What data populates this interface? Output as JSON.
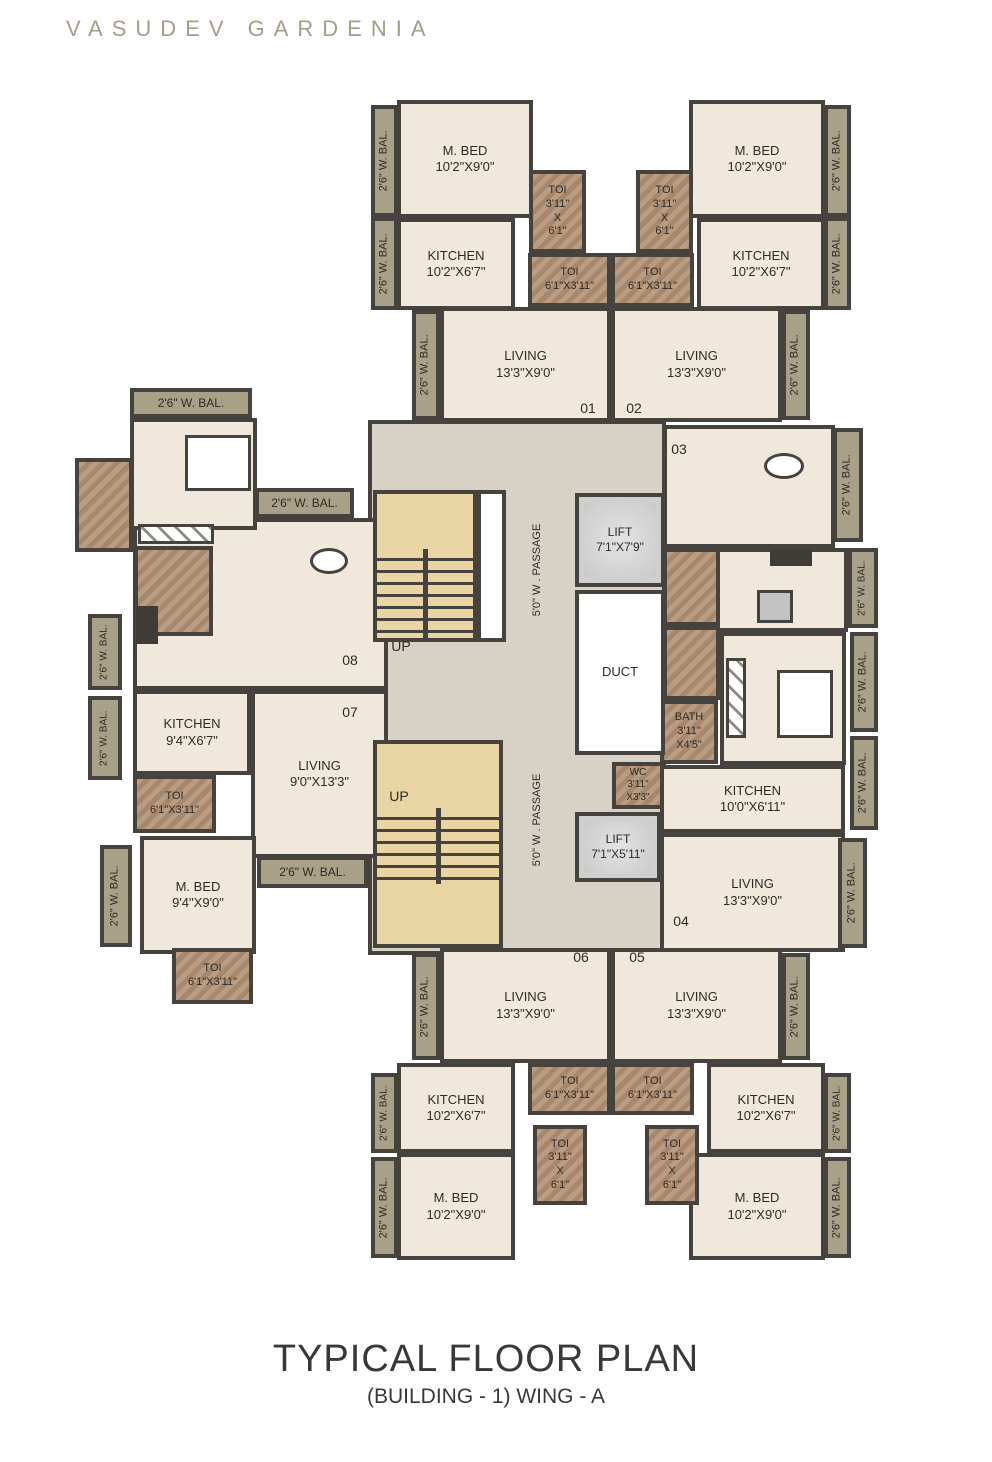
{
  "header": {
    "title": "VASUDEV GARDENIA"
  },
  "footer": {
    "title": "TYPICAL FLOOR PLAN",
    "subtitle": "(BUILDING - 1) WING - A"
  },
  "colors": {
    "wall": "#46433e",
    "floor": "#f0e9db",
    "balcony": "#a9a187",
    "toilet": "#b19174",
    "stair": "#e9d4a4",
    "lift": "#d4d4d4",
    "passage": "#d8d2c6",
    "title": "#a49d87",
    "text": "#2d2b27"
  },
  "plan": {
    "rooms": [
      {
        "id": "passage-core",
        "kind": "core",
        "x": 368,
        "y": 420,
        "w": 298,
        "h": 535
      },
      {
        "id": "mbed-01",
        "kind": "room",
        "x": 397,
        "y": 100,
        "w": 136,
        "h": 118,
        "lines": [
          "M. BED",
          "10'2\"X9'0\""
        ]
      },
      {
        "id": "kitchen-01",
        "kind": "room",
        "x": 397,
        "y": 218,
        "w": 118,
        "h": 92,
        "lines": [
          "KITCHEN",
          "10'2\"X6'7\""
        ]
      },
      {
        "id": "mbed-02",
        "kind": "room",
        "x": 689,
        "y": 100,
        "w": 136,
        "h": 118,
        "lines": [
          "M. BED",
          "10'2\"X9'0\""
        ]
      },
      {
        "id": "kitchen-02",
        "kind": "room",
        "x": 697,
        "y": 218,
        "w": 128,
        "h": 92,
        "lines": [
          "KITCHEN",
          "10'2\"X6'7\""
        ]
      },
      {
        "id": "living-01",
        "kind": "room",
        "x": 440,
        "y": 307,
        "w": 171,
        "h": 115,
        "lines": [
          "LIVING",
          "13'3\"X9'0\""
        ]
      },
      {
        "id": "living-02",
        "kind": "room",
        "x": 611,
        "y": 307,
        "w": 171,
        "h": 115,
        "lines": [
          "LIVING",
          "13'3\"X9'0\""
        ]
      },
      {
        "id": "living-08",
        "kind": "room",
        "x": 133,
        "y": 518,
        "w": 255,
        "h": 172
      },
      {
        "id": "bedroom-08",
        "kind": "room",
        "x": 130,
        "y": 418,
        "w": 127,
        "h": 112
      },
      {
        "id": "kitchen-07",
        "kind": "room",
        "x": 133,
        "y": 690,
        "w": 118,
        "h": 85,
        "lines": [
          "KITCHEN",
          "9'4\"X6'7\""
        ]
      },
      {
        "id": "living-07",
        "kind": "room",
        "x": 251,
        "y": 690,
        "w": 137,
        "h": 168,
        "lines": [
          "LIVING",
          "9'0\"X13'3\""
        ]
      },
      {
        "id": "mbed-07",
        "kind": "room",
        "x": 140,
        "y": 836,
        "w": 116,
        "h": 118,
        "lines": [
          "M. BED",
          "9'4\"X9'0\""
        ]
      },
      {
        "id": "living-03",
        "kind": "room",
        "x": 663,
        "y": 425,
        "w": 172,
        "h": 123
      },
      {
        "id": "kitchen-03",
        "kind": "room",
        "x": 663,
        "y": 548,
        "w": 185,
        "h": 84
      },
      {
        "id": "bedroom-03",
        "kind": "room",
        "x": 720,
        "y": 632,
        "w": 126,
        "h": 133
      },
      {
        "id": "kitchen-04",
        "kind": "room",
        "x": 660,
        "y": 765,
        "w": 185,
        "h": 68,
        "lines": [
          "KITCHEN",
          "10'0\"X6'11\""
        ]
      },
      {
        "id": "living-04",
        "kind": "room",
        "x": 660,
        "y": 833,
        "w": 185,
        "h": 119,
        "lines": [
          "LIVING",
          "13'3\"X9'0\""
        ]
      },
      {
        "id": "living-06",
        "kind": "room",
        "x": 440,
        "y": 948,
        "w": 171,
        "h": 115,
        "lines": [
          "LIVING",
          "13'3\"X9'0\""
        ]
      },
      {
        "id": "living-05",
        "kind": "room",
        "x": 611,
        "y": 948,
        "w": 171,
        "h": 115,
        "lines": [
          "LIVING",
          "13'3\"X9'0\""
        ]
      },
      {
        "id": "kitchen-06",
        "kind": "room",
        "x": 397,
        "y": 1063,
        "w": 118,
        "h": 90,
        "lines": [
          "KITCHEN",
          "10'2\"X6'7\""
        ]
      },
      {
        "id": "kitchen-05",
        "kind": "room",
        "x": 707,
        "y": 1063,
        "w": 118,
        "h": 90,
        "lines": [
          "KITCHEN",
          "10'2\"X6'7\""
        ]
      },
      {
        "id": "mbed-06",
        "kind": "room",
        "x": 397,
        "y": 1153,
        "w": 118,
        "h": 107,
        "lines": [
          "M. BED",
          "10'2\"X9'0\""
        ]
      },
      {
        "id": "mbed-05",
        "kind": "room",
        "x": 689,
        "y": 1153,
        "w": 136,
        "h": 107,
        "lines": [
          "M. BED",
          "10'2\"X9'0\""
        ]
      },
      {
        "id": "toi-01-a",
        "kind": "toi",
        "x": 529,
        "y": 170,
        "w": 57,
        "h": 83,
        "lines": [
          "TOI",
          "3'11\"",
          "X",
          "6'1\""
        ],
        "fs": 11
      },
      {
        "id": "toi-01-b",
        "kind": "toi",
        "x": 528,
        "y": 253,
        "w": 83,
        "h": 54,
        "lines": [
          "TOI",
          "6'1\"X3'11\""
        ],
        "fs": 11
      },
      {
        "id": "toi-02-a",
        "kind": "toi",
        "x": 636,
        "y": 170,
        "w": 57,
        "h": 83,
        "lines": [
          "TOI",
          "3'11\"",
          "X",
          "6'1\""
        ],
        "fs": 11
      },
      {
        "id": "toi-02-b",
        "kind": "toi",
        "x": 611,
        "y": 253,
        "w": 83,
        "h": 54,
        "lines": [
          "TOI",
          "6'1\"X3'11\""
        ],
        "fs": 11
      },
      {
        "id": "toi-08-a",
        "kind": "toi",
        "x": 75,
        "y": 458,
        "w": 58,
        "h": 94
      },
      {
        "id": "toi-08-b",
        "kind": "toi",
        "x": 134,
        "y": 546,
        "w": 79,
        "h": 90
      },
      {
        "id": "toi-07",
        "kind": "toi",
        "x": 133,
        "y": 775,
        "w": 83,
        "h": 58,
        "lines": [
          "TOI",
          "6'1\"X3'11\""
        ],
        "fs": 11
      },
      {
        "id": "toi-07-b",
        "kind": "toi",
        "x": 172,
        "y": 948,
        "w": 81,
        "h": 56,
        "lines": [
          "TOI",
          "6'1\"X3'11\""
        ],
        "fs": 11
      },
      {
        "id": "toi-03-a",
        "kind": "toi",
        "x": 663,
        "y": 548,
        "w": 57,
        "h": 78
      },
      {
        "id": "toi-03-b",
        "kind": "toi",
        "x": 663,
        "y": 626,
        "w": 57,
        "h": 74
      },
      {
        "id": "bath-03",
        "kind": "toi",
        "x": 660,
        "y": 700,
        "w": 58,
        "h": 64,
        "lines": [
          "BATH",
          "3'11\"",
          "X4'5\""
        ],
        "fs": 11
      },
      {
        "id": "wc",
        "kind": "toi",
        "x": 612,
        "y": 762,
        "w": 52,
        "h": 47,
        "lines": [
          "WC",
          "3'11\"",
          "X3'3\""
        ],
        "fs": 10
      },
      {
        "id": "toi-06-a",
        "kind": "toi",
        "x": 528,
        "y": 1063,
        "w": 83,
        "h": 52,
        "lines": [
          "TOI",
          "6'1\"X3'11\""
        ],
        "fs": 11
      },
      {
        "id": "toi-05-a",
        "kind": "toi",
        "x": 611,
        "y": 1063,
        "w": 83,
        "h": 52,
        "lines": [
          "TOI",
          "6'1\"X3'11\""
        ],
        "fs": 11
      },
      {
        "id": "toi-06-b",
        "kind": "toi",
        "x": 533,
        "y": 1125,
        "w": 54,
        "h": 80,
        "lines": [
          "TOI",
          "3'11\"",
          "X",
          "6'1\""
        ],
        "fs": 11
      },
      {
        "id": "toi-05-b",
        "kind": "toi",
        "x": 645,
        "y": 1125,
        "w": 54,
        "h": 80,
        "lines": [
          "TOI",
          "3'11\"",
          "X",
          "6'1\""
        ],
        "fs": 11
      },
      {
        "id": "stairs-upper",
        "kind": "stair",
        "x": 373,
        "y": 490,
        "w": 104,
        "h": 152,
        "treads": [
          0.38,
          1.0
        ]
      },
      {
        "id": "stair-landing",
        "kind": "landing",
        "x": 477,
        "y": 490,
        "w": 29,
        "h": 152
      },
      {
        "id": "stairs-lower",
        "kind": "stair",
        "x": 373,
        "y": 740,
        "w": 130,
        "h": 208,
        "treads": [
          0.32,
          0.7
        ]
      },
      {
        "id": "lift-upper",
        "kind": "lift",
        "x": 575,
        "y": 493,
        "w": 90,
        "h": 94,
        "lines": [
          "LIFT",
          "7'1\"X7'9\""
        ],
        "fs": 12
      },
      {
        "id": "duct",
        "kind": "duct",
        "x": 575,
        "y": 590,
        "w": 90,
        "h": 165,
        "lines": [
          "DUCT"
        ],
        "fs": 13
      },
      {
        "id": "lift-lower",
        "kind": "lift",
        "x": 575,
        "y": 812,
        "w": 86,
        "h": 70,
        "lines": [
          "LIFT",
          "7'1\"X5'11\""
        ],
        "fs": 12
      },
      {
        "id": "balcony",
        "kind": "bal",
        "x": 371,
        "y": 105,
        "w": 27,
        "h": 112,
        "rot": 1,
        "lines": [
          "2'6\" W. BAL."
        ],
        "fs": 11
      },
      {
        "id": "balcony",
        "kind": "bal",
        "x": 371,
        "y": 217,
        "w": 27,
        "h": 93,
        "rot": 1,
        "lines": [
          "2'6\" W. BAL."
        ],
        "fs": 11
      },
      {
        "id": "balcony",
        "kind": "bal",
        "x": 824,
        "y": 105,
        "w": 27,
        "h": 112,
        "rot": 1,
        "lines": [
          "2'6\" W. BAL."
        ],
        "fs": 11
      },
      {
        "id": "balcony",
        "kind": "bal",
        "x": 824,
        "y": 217,
        "w": 27,
        "h": 93,
        "rot": 1,
        "lines": [
          "2'6\" W. BAL."
        ],
        "fs": 11
      },
      {
        "id": "balcony",
        "kind": "bal",
        "x": 412,
        "y": 310,
        "w": 28,
        "h": 110,
        "rot": 1,
        "lines": [
          "2'6\" W. BAL."
        ],
        "fs": 11
      },
      {
        "id": "balcony",
        "kind": "bal",
        "x": 782,
        "y": 310,
        "w": 28,
        "h": 110,
        "rot": 1,
        "lines": [
          "2'6\" W. BAL."
        ],
        "fs": 11
      },
      {
        "id": "balcony",
        "kind": "bal",
        "x": 130,
        "y": 388,
        "w": 122,
        "h": 30,
        "lines": [
          "2'6\" W. BAL."
        ],
        "fs": 12
      },
      {
        "id": "balcony",
        "kind": "bal",
        "x": 255,
        "y": 488,
        "w": 99,
        "h": 30,
        "lines": [
          "2'6\" W. BAL."
        ],
        "fs": 12
      },
      {
        "id": "balcony",
        "kind": "bal",
        "x": 88,
        "y": 614,
        "w": 34,
        "h": 76,
        "rot": 1,
        "lines": [
          "2'6\" W. BAL."
        ],
        "fs": 10
      },
      {
        "id": "balcony",
        "kind": "bal",
        "x": 88,
        "y": 696,
        "w": 34,
        "h": 84,
        "rot": 1,
        "lines": [
          "2'6\" W. BAL."
        ],
        "fs": 10
      },
      {
        "id": "balcony",
        "kind": "bal",
        "x": 100,
        "y": 845,
        "w": 32,
        "h": 102,
        "rot": 1,
        "lines": [
          "2'6\" W. BAL."
        ],
        "fs": 11
      },
      {
        "id": "balcony",
        "kind": "bal",
        "x": 257,
        "y": 856,
        "w": 111,
        "h": 32,
        "lines": [
          "2'6\" W. BAL."
        ],
        "fs": 12
      },
      {
        "id": "balcony",
        "kind": "bal",
        "x": 833,
        "y": 428,
        "w": 30,
        "h": 114,
        "rot": 1,
        "lines": [
          "2'6\" W. BAL."
        ],
        "fs": 11
      },
      {
        "id": "balcony",
        "kind": "bal",
        "x": 848,
        "y": 548,
        "w": 30,
        "h": 80,
        "rot": 1,
        "lines": [
          "2'6\" W. BAL."
        ],
        "fs": 10
      },
      {
        "id": "balcony",
        "kind": "bal",
        "x": 850,
        "y": 632,
        "w": 28,
        "h": 100,
        "rot": 1,
        "lines": [
          "2'6\" W. BAL."
        ],
        "fs": 11
      },
      {
        "id": "balcony",
        "kind": "bal",
        "x": 850,
        "y": 736,
        "w": 28,
        "h": 94,
        "rot": 1,
        "lines": [
          "2'6\" W. BAL."
        ],
        "fs": 11
      },
      {
        "id": "balcony",
        "kind": "bal",
        "x": 838,
        "y": 838,
        "w": 29,
        "h": 110,
        "rot": 1,
        "lines": [
          "2'6\" W. BAL."
        ],
        "fs": 11
      },
      {
        "id": "balcony",
        "kind": "bal",
        "x": 412,
        "y": 953,
        "w": 28,
        "h": 107,
        "rot": 1,
        "lines": [
          "2'6\" W. BAL."
        ],
        "fs": 11
      },
      {
        "id": "balcony",
        "kind": "bal",
        "x": 782,
        "y": 953,
        "w": 28,
        "h": 107,
        "rot": 1,
        "lines": [
          "2'6\" W. BAL."
        ],
        "fs": 11
      },
      {
        "id": "balcony",
        "kind": "bal",
        "x": 371,
        "y": 1073,
        "w": 27,
        "h": 80,
        "rot": 1,
        "lines": [
          "2'6\" W. BAL."
        ],
        "fs": 10
      },
      {
        "id": "balcony",
        "kind": "bal",
        "x": 371,
        "y": 1157,
        "w": 27,
        "h": 101,
        "rot": 1,
        "lines": [
          "2'6\" W. BAL."
        ],
        "fs": 11
      },
      {
        "id": "balcony",
        "kind": "bal",
        "x": 824,
        "y": 1073,
        "w": 27,
        "h": 80,
        "rot": 1,
        "lines": [
          "2'6\" W. BAL."
        ],
        "fs": 10
      },
      {
        "id": "balcony",
        "kind": "bal",
        "x": 824,
        "y": 1157,
        "w": 27,
        "h": 101,
        "rot": 1,
        "lines": [
          "2'6\" W. BAL."
        ],
        "fs": 11
      }
    ],
    "texts": [
      {
        "t": "01",
        "x": 588,
        "y": 408
      },
      {
        "t": "02",
        "x": 634,
        "y": 408
      },
      {
        "t": "03",
        "x": 679,
        "y": 449
      },
      {
        "t": "04",
        "x": 681,
        "y": 921
      },
      {
        "t": "05",
        "x": 637,
        "y": 957
      },
      {
        "t": "06",
        "x": 581,
        "y": 957
      },
      {
        "t": "07",
        "x": 350,
        "y": 712
      },
      {
        "t": "08",
        "x": 350,
        "y": 660
      },
      {
        "t": "UP",
        "x": 401,
        "y": 646
      },
      {
        "t": "UP",
        "x": 399,
        "y": 796
      },
      {
        "t": "5'0\" W . PASSAGE",
        "x": 537,
        "y": 570,
        "rot": 1,
        "fs": 11
      },
      {
        "t": "5'0\" W . PASSAGE",
        "x": 537,
        "y": 820,
        "rot": 1,
        "fs": 11
      }
    ],
    "deco": [
      {
        "kind": "bed",
        "x": 185,
        "y": 435,
        "w": 66,
        "h": 56
      },
      {
        "kind": "bed",
        "x": 777,
        "y": 670,
        "w": 56,
        "h": 68
      },
      {
        "kind": "oval",
        "x": 764,
        "y": 453,
        "w": 40,
        "h": 26
      },
      {
        "kind": "oval",
        "x": 310,
        "y": 548,
        "w": 38,
        "h": 26
      },
      {
        "kind": "box",
        "x": 757,
        "y": 590,
        "w": 36,
        "h": 33
      },
      {
        "kind": "dark",
        "x": 770,
        "y": 550,
        "w": 42,
        "h": 16
      },
      {
        "kind": "dark",
        "x": 136,
        "y": 606,
        "w": 22,
        "h": 38
      },
      {
        "kind": "wardrobe",
        "x": 726,
        "y": 658,
        "w": 20,
        "h": 80
      },
      {
        "kind": "wardrobe",
        "x": 138,
        "y": 524,
        "w": 76,
        "h": 20
      }
    ]
  }
}
